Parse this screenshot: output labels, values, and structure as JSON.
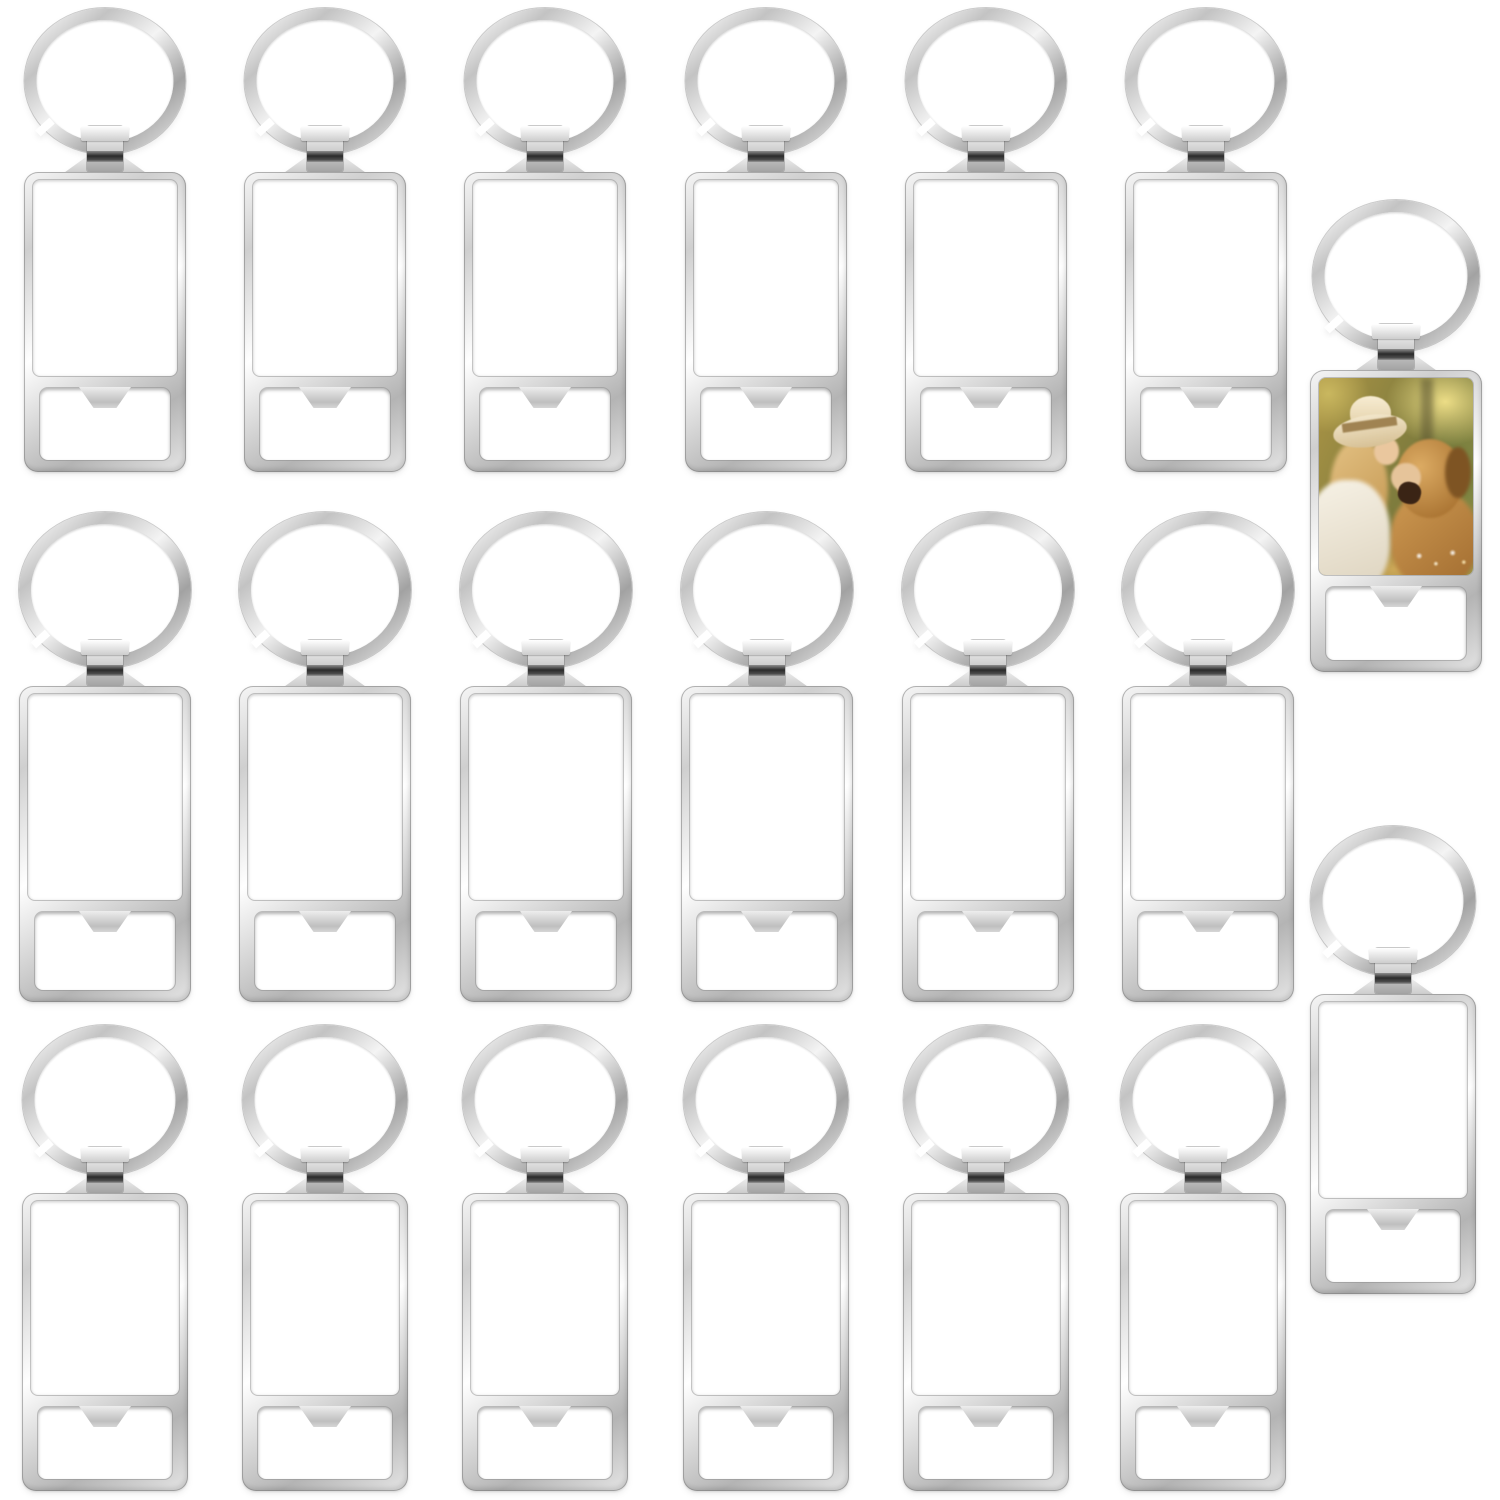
{
  "scene": {
    "kind": "product-photo",
    "subject": "sublimation blank bottle-opener keychains",
    "background_color": "#ffffff",
    "total_keychains": 20,
    "blank_keychains": 19,
    "printed_sample_keychains": 1,
    "grid": {
      "rows": 3,
      "columns": 6,
      "side_items": 2
    }
  },
  "colors": {
    "metal_highlight": "#ffffff",
    "metal_light": "#f4f4f4",
    "metal_mid": "#d2d2d2",
    "metal_shadow": "#a6a6a6",
    "metal_edge": "#8a8a8a",
    "clamp_band_dark": "#2a2a2a",
    "panel_white": "#ffffff"
  },
  "photo_insert": {
    "description": "sample print: woman in a beige sun hat smiling nose-to-nose with a golden retriever in a warm sunlit field",
    "palette": [
      "#ab9445",
      "#ecdd86",
      "#f2e6ca",
      "#a08352",
      "#dcab63",
      "#7e5423",
      "#f7f2e6",
      "#3a2415"
    ]
  },
  "keychains": [
    {
      "id": "row1-col1",
      "type": "blank",
      "cx": 105,
      "top": 8,
      "ring_d": 146,
      "body_w": 162,
      "body_h": 300
    },
    {
      "id": "row1-col2",
      "type": "blank",
      "cx": 325,
      "top": 8,
      "ring_d": 146,
      "body_w": 162,
      "body_h": 300
    },
    {
      "id": "row1-col3",
      "type": "blank",
      "cx": 545,
      "top": 8,
      "ring_d": 146,
      "body_w": 162,
      "body_h": 300
    },
    {
      "id": "row1-col4",
      "type": "blank",
      "cx": 766,
      "top": 8,
      "ring_d": 146,
      "body_w": 162,
      "body_h": 300
    },
    {
      "id": "row1-col5",
      "type": "blank",
      "cx": 986,
      "top": 8,
      "ring_d": 146,
      "body_w": 162,
      "body_h": 300
    },
    {
      "id": "row1-col6",
      "type": "blank",
      "cx": 1206,
      "top": 8,
      "ring_d": 146,
      "body_w": 162,
      "body_h": 300
    },
    {
      "id": "row2-col1",
      "type": "blank",
      "cx": 105,
      "top": 512,
      "ring_d": 156,
      "body_w": 172,
      "body_h": 316
    },
    {
      "id": "row2-col2",
      "type": "blank",
      "cx": 325,
      "top": 512,
      "ring_d": 156,
      "body_w": 172,
      "body_h": 316
    },
    {
      "id": "row2-col3",
      "type": "blank",
      "cx": 546,
      "top": 512,
      "ring_d": 156,
      "body_w": 172,
      "body_h": 316
    },
    {
      "id": "row2-col4",
      "type": "blank",
      "cx": 767,
      "top": 512,
      "ring_d": 156,
      "body_w": 172,
      "body_h": 316
    },
    {
      "id": "row2-col5",
      "type": "blank",
      "cx": 988,
      "top": 512,
      "ring_d": 156,
      "body_w": 172,
      "body_h": 316
    },
    {
      "id": "row2-col6",
      "type": "blank",
      "cx": 1208,
      "top": 512,
      "ring_d": 156,
      "body_w": 172,
      "body_h": 316
    },
    {
      "id": "row3-col1",
      "type": "blank",
      "cx": 105,
      "top": 1025,
      "ring_d": 150,
      "body_w": 166,
      "body_h": 298
    },
    {
      "id": "row3-col2",
      "type": "blank",
      "cx": 325,
      "top": 1025,
      "ring_d": 150,
      "body_w": 166,
      "body_h": 298
    },
    {
      "id": "row3-col3",
      "type": "blank",
      "cx": 545,
      "top": 1025,
      "ring_d": 150,
      "body_w": 166,
      "body_h": 298
    },
    {
      "id": "row3-col4",
      "type": "blank",
      "cx": 766,
      "top": 1025,
      "ring_d": 150,
      "body_w": 166,
      "body_h": 298
    },
    {
      "id": "row3-col5",
      "type": "blank",
      "cx": 986,
      "top": 1025,
      "ring_d": 150,
      "body_w": 166,
      "body_h": 298
    },
    {
      "id": "row3-col6",
      "type": "blank",
      "cx": 1203,
      "top": 1025,
      "ring_d": 150,
      "body_w": 166,
      "body_h": 298
    },
    {
      "id": "side-printed-sample",
      "type": "photo",
      "cx": 1396,
      "top": 200,
      "ring_d": 152,
      "body_w": 172,
      "body_h": 302
    },
    {
      "id": "side-blank",
      "type": "blank",
      "cx": 1393,
      "top": 826,
      "ring_d": 150,
      "body_w": 166,
      "body_h": 300
    }
  ]
}
